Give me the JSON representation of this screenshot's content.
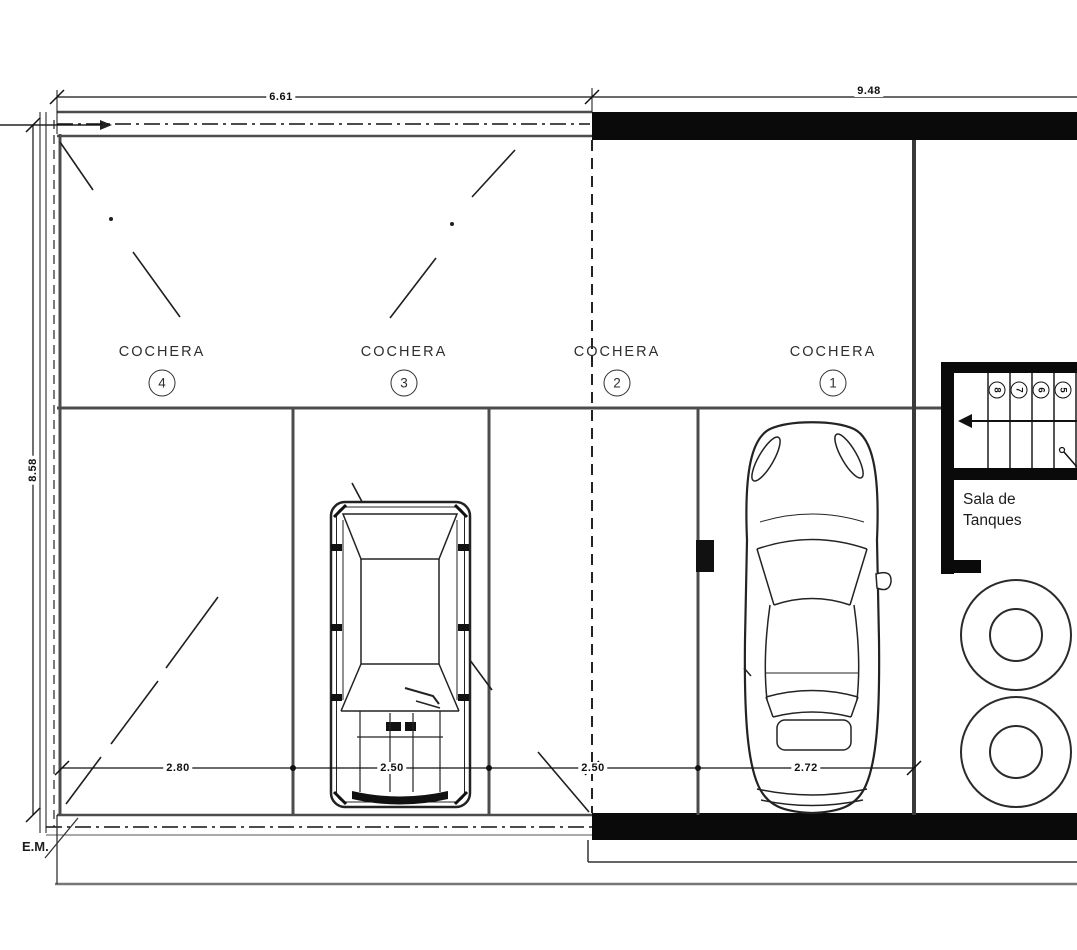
{
  "labels": {
    "parking_spots": [
      {
        "name": "COCHERA",
        "number": "4"
      },
      {
        "name": "COCHERA",
        "number": "3"
      },
      {
        "name": "COCHERA",
        "number": "2"
      },
      {
        "name": "COCHERA",
        "number": "1"
      }
    ],
    "tank_room": {
      "line1": "Sala de",
      "line2": "Tanques"
    },
    "em": "E.M."
  },
  "dimensions": {
    "top_left_width": "6.61",
    "top_right_width": "9.48",
    "left_height": "8.58",
    "stall_widths": [
      "2.80",
      "2.50",
      "2.50",
      "2.72"
    ]
  },
  "stairs": {
    "step_numbers": [
      "8",
      "7",
      "6",
      "5"
    ]
  },
  "colors": {
    "background": "#ffffff",
    "wall_gray": "#4c4c4c",
    "heavy_wall": "#0a0a0a",
    "ink": "#111111"
  }
}
